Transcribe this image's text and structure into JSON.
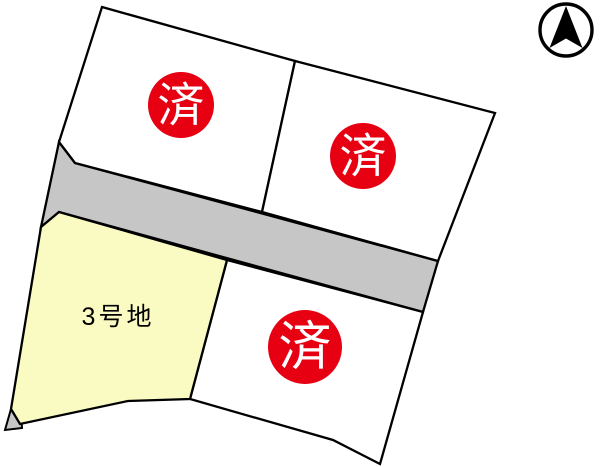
{
  "title": "lot-site-plan",
  "colors": {
    "sold_red": "#e60012",
    "badge_text": "#ffffff",
    "lot_yellow": "#fafac3",
    "road_gray": "#c6c6c6",
    "outline": "#000000",
    "lot_white": "#ffffff",
    "label_text": "#000000",
    "compass_black": "#000000"
  },
  "lots": [
    {
      "name": "top-left",
      "badge": "済"
    },
    {
      "name": "top-right",
      "badge": "済"
    },
    {
      "name": "no-3",
      "label": "3号地"
    },
    {
      "name": "bottom-right",
      "badge": "済"
    }
  ],
  "compass": {
    "name": "north-arrow"
  }
}
